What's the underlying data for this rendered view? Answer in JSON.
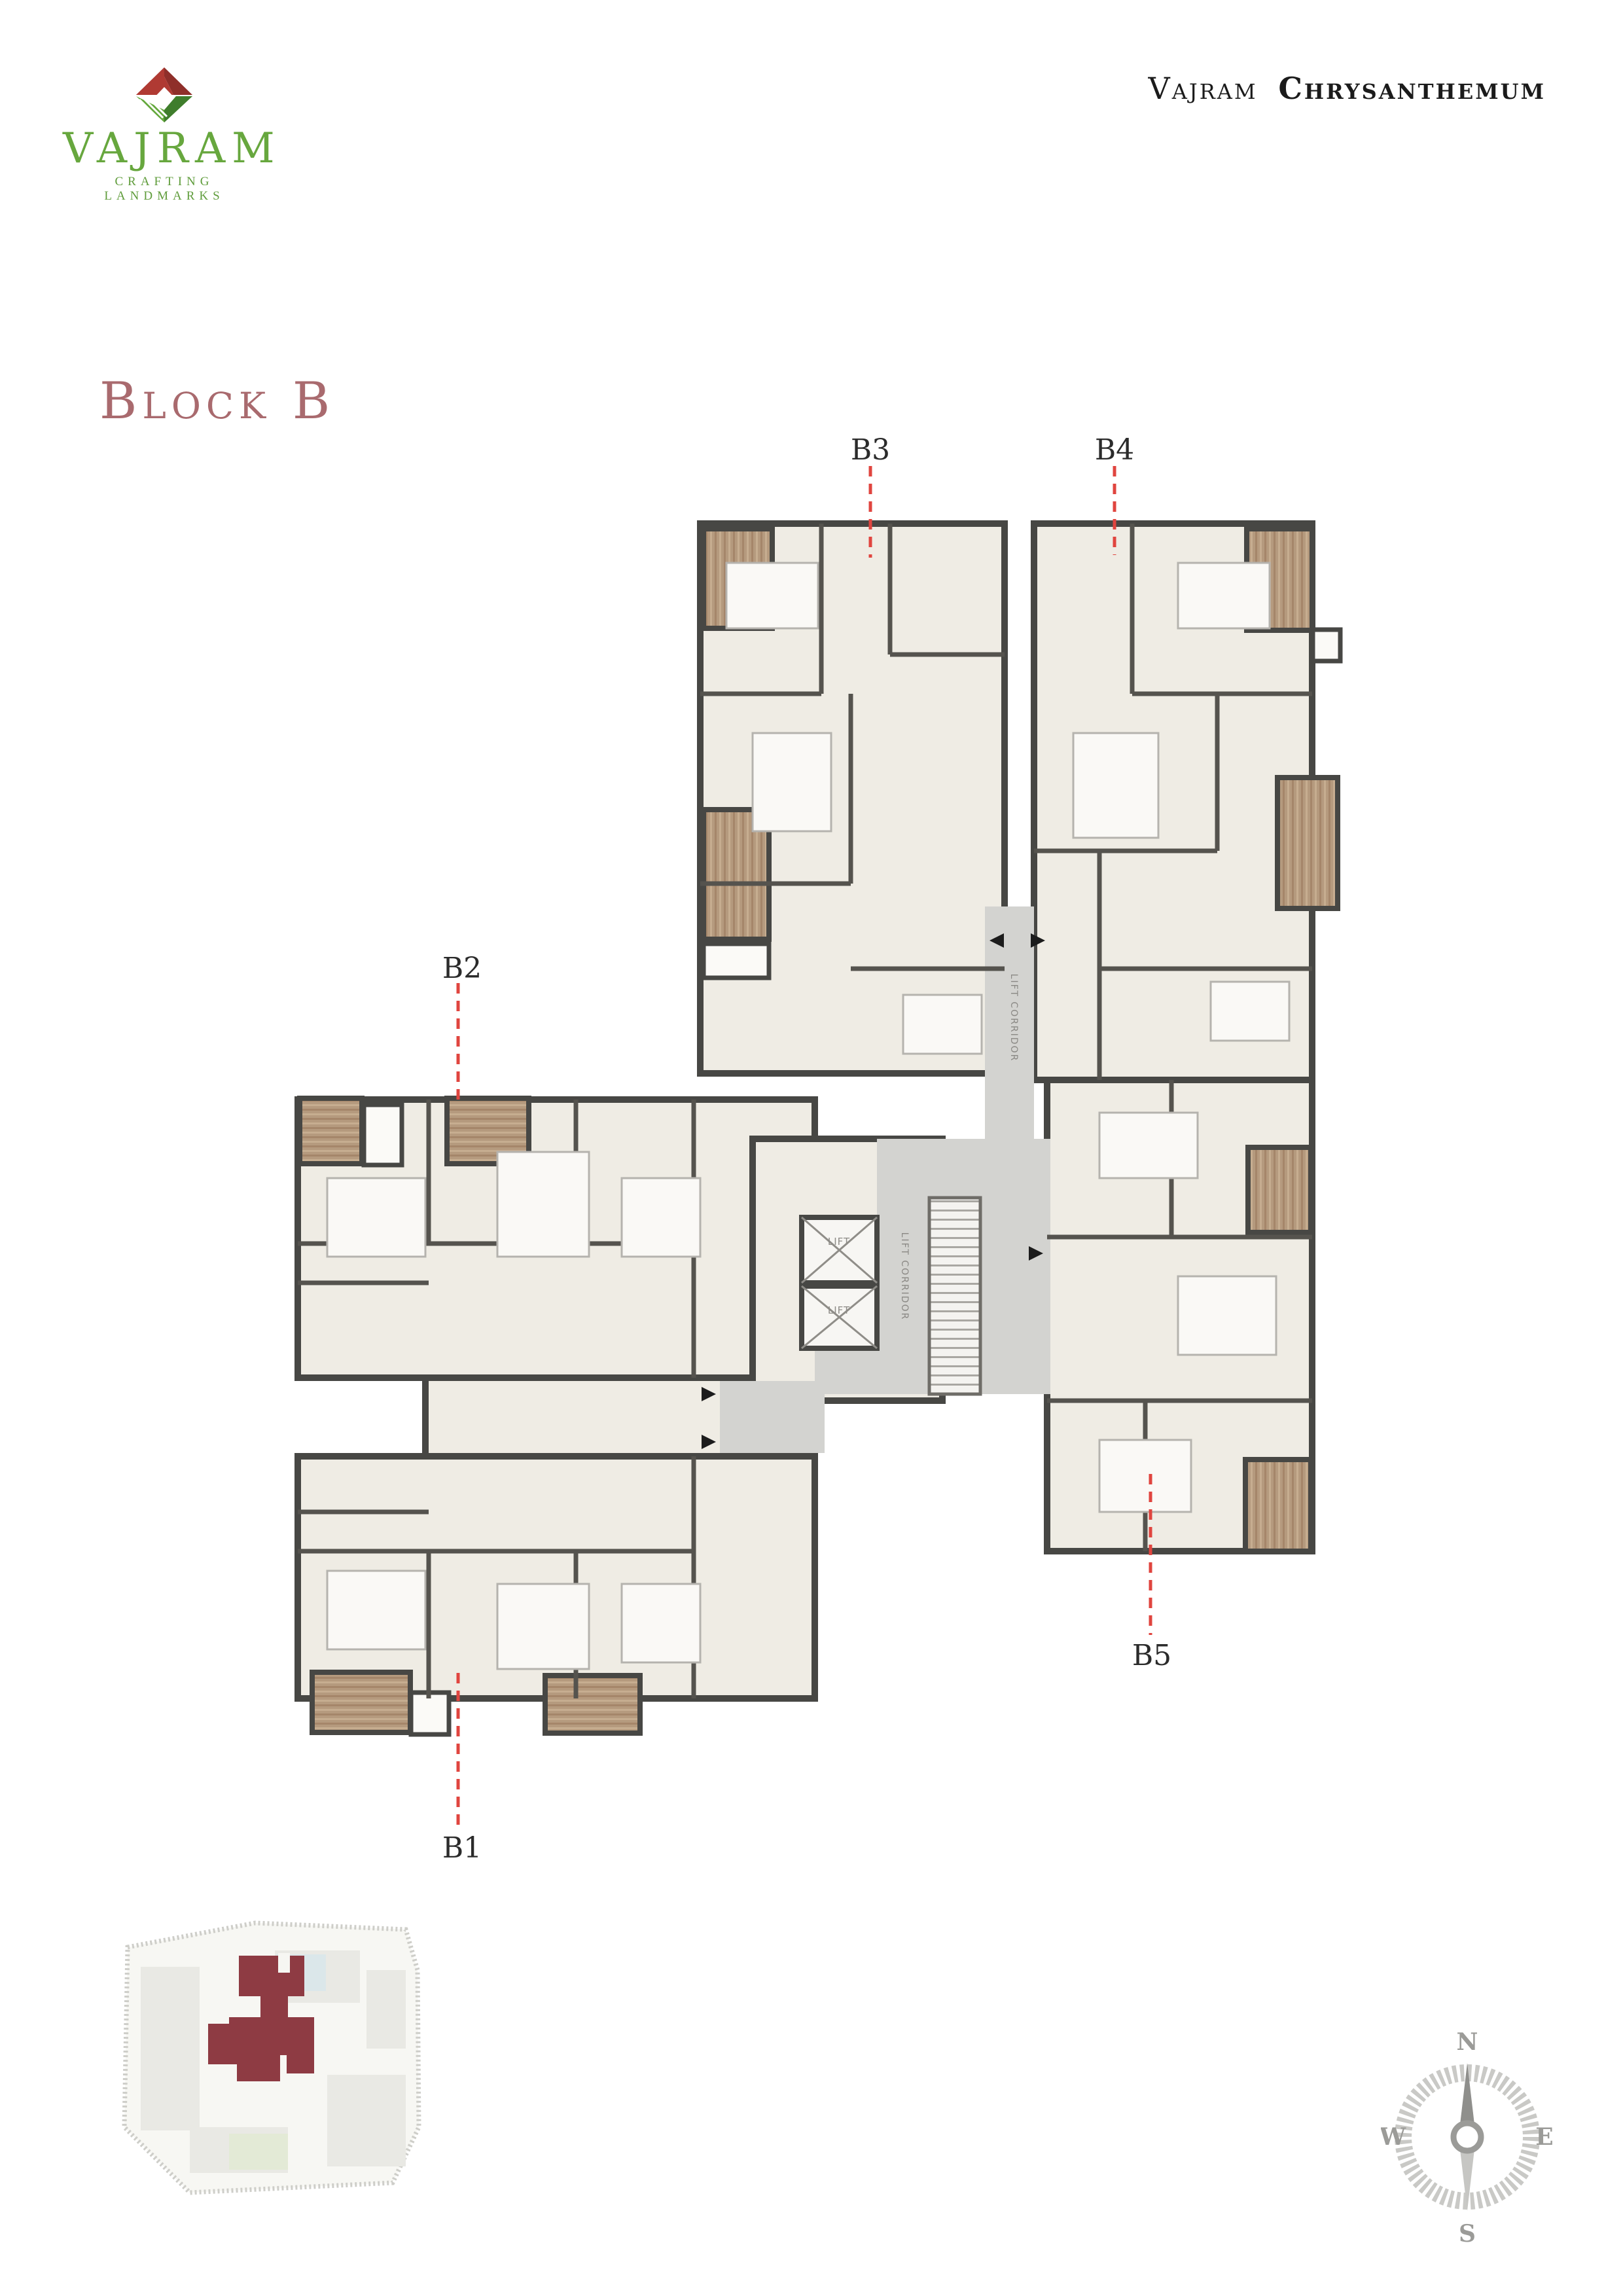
{
  "header": {
    "brand": "VAJRAM",
    "tagline": "CRAFTING LANDMARKS",
    "title": {
      "prefix": "Vajram",
      "name": "Chrysanthemum"
    }
  },
  "heading": "Block B",
  "plan": {
    "units": [
      {
        "id": "B1",
        "label": "B1"
      },
      {
        "id": "B2",
        "label": "B2"
      },
      {
        "id": "B3",
        "label": "B3"
      },
      {
        "id": "B4",
        "label": "B4"
      },
      {
        "id": "B5",
        "label": "B5"
      }
    ],
    "lift_label": "LIFT",
    "corridor_label": "LIFT CORRIDOR"
  },
  "compass": {
    "north": "N",
    "south": "S",
    "east": "E",
    "west": "W"
  },
  "colors": {
    "brand_green": "#67a73e",
    "logo_red": "#b03a33",
    "heading_rose": "#a96a6e",
    "leader_red": "#e0453f",
    "wall_dark": "#474744",
    "room_fill": "#efece4",
    "balcony_wood": "#b59a7e",
    "corridor_gray": "#d3d3d0",
    "site_highlight": "#8e3b43",
    "compass_gray": "#9b9b98"
  }
}
